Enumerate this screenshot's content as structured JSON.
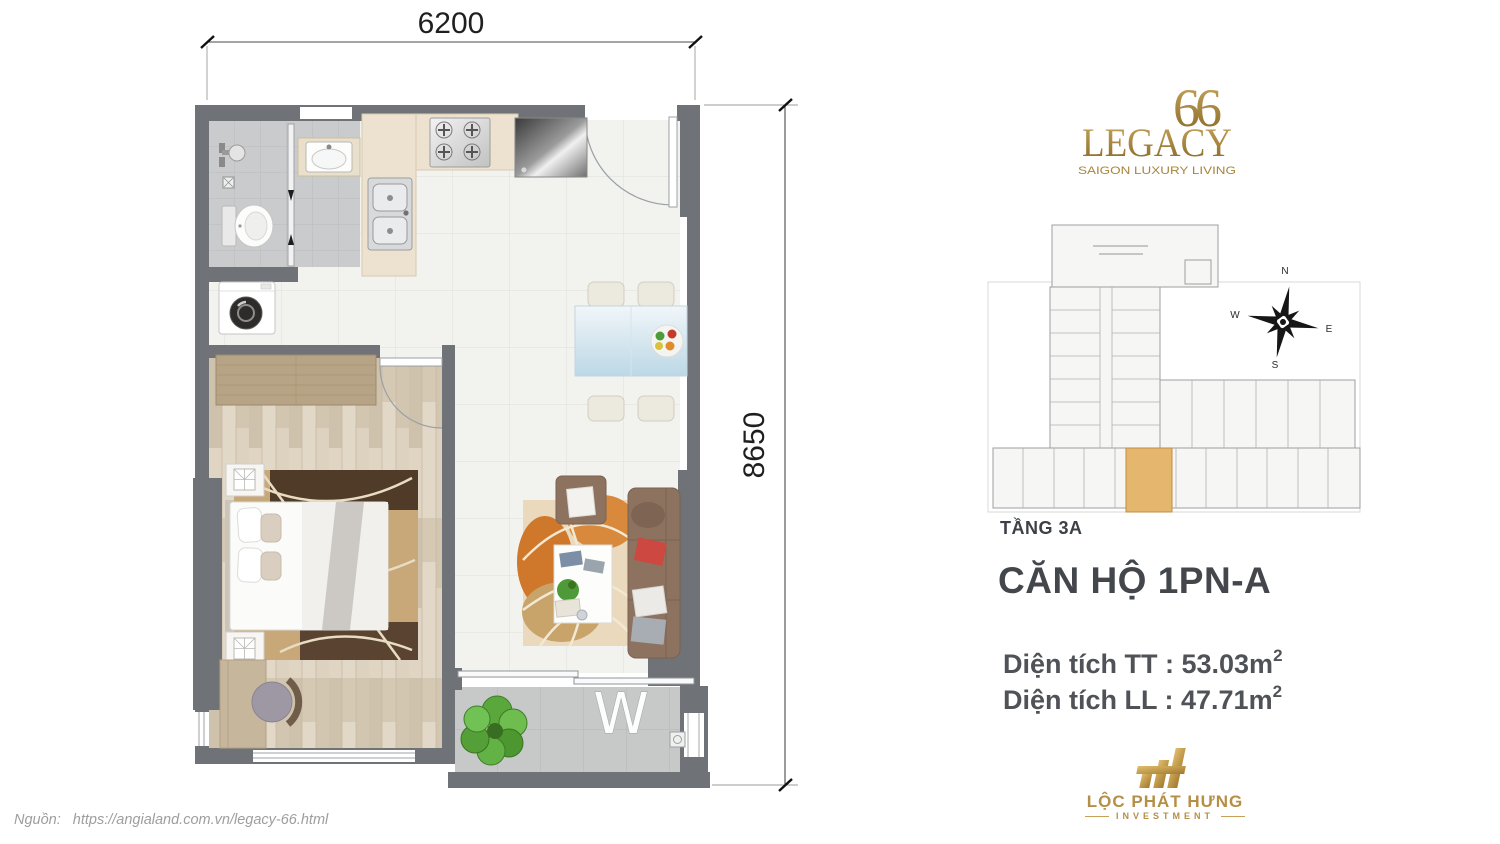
{
  "page": {
    "source_label": "Nguồn:",
    "source_url": "https://angialand.com.vn/legacy-66.html"
  },
  "floor_plan": {
    "dim_width": "6200",
    "dim_height": "8650",
    "balcony_washer_label": "W",
    "wall_color": "#6f7277"
  },
  "brand": {
    "monogram": "66",
    "name": "LEGACY",
    "tagline": "SAIGON LUXURY LIVING",
    "gold": "#a8863c"
  },
  "site_plan": {
    "floor_label": "TẦNG 3A",
    "compass": {
      "north": "N",
      "east": "E",
      "south": "S",
      "west": "W"
    },
    "highlight_color": "#e5b66e"
  },
  "unit": {
    "title": "CĂN HỘ 1PN-A",
    "areas": [
      {
        "text": "Diện tích TT : 53.03m",
        "sup": "2"
      },
      {
        "text": "Diện tích LL : 47.71m",
        "sup": "2"
      }
    ]
  },
  "developer": {
    "name": "LỘC PHÁT HƯNG",
    "division": "INVESTMENT"
  }
}
